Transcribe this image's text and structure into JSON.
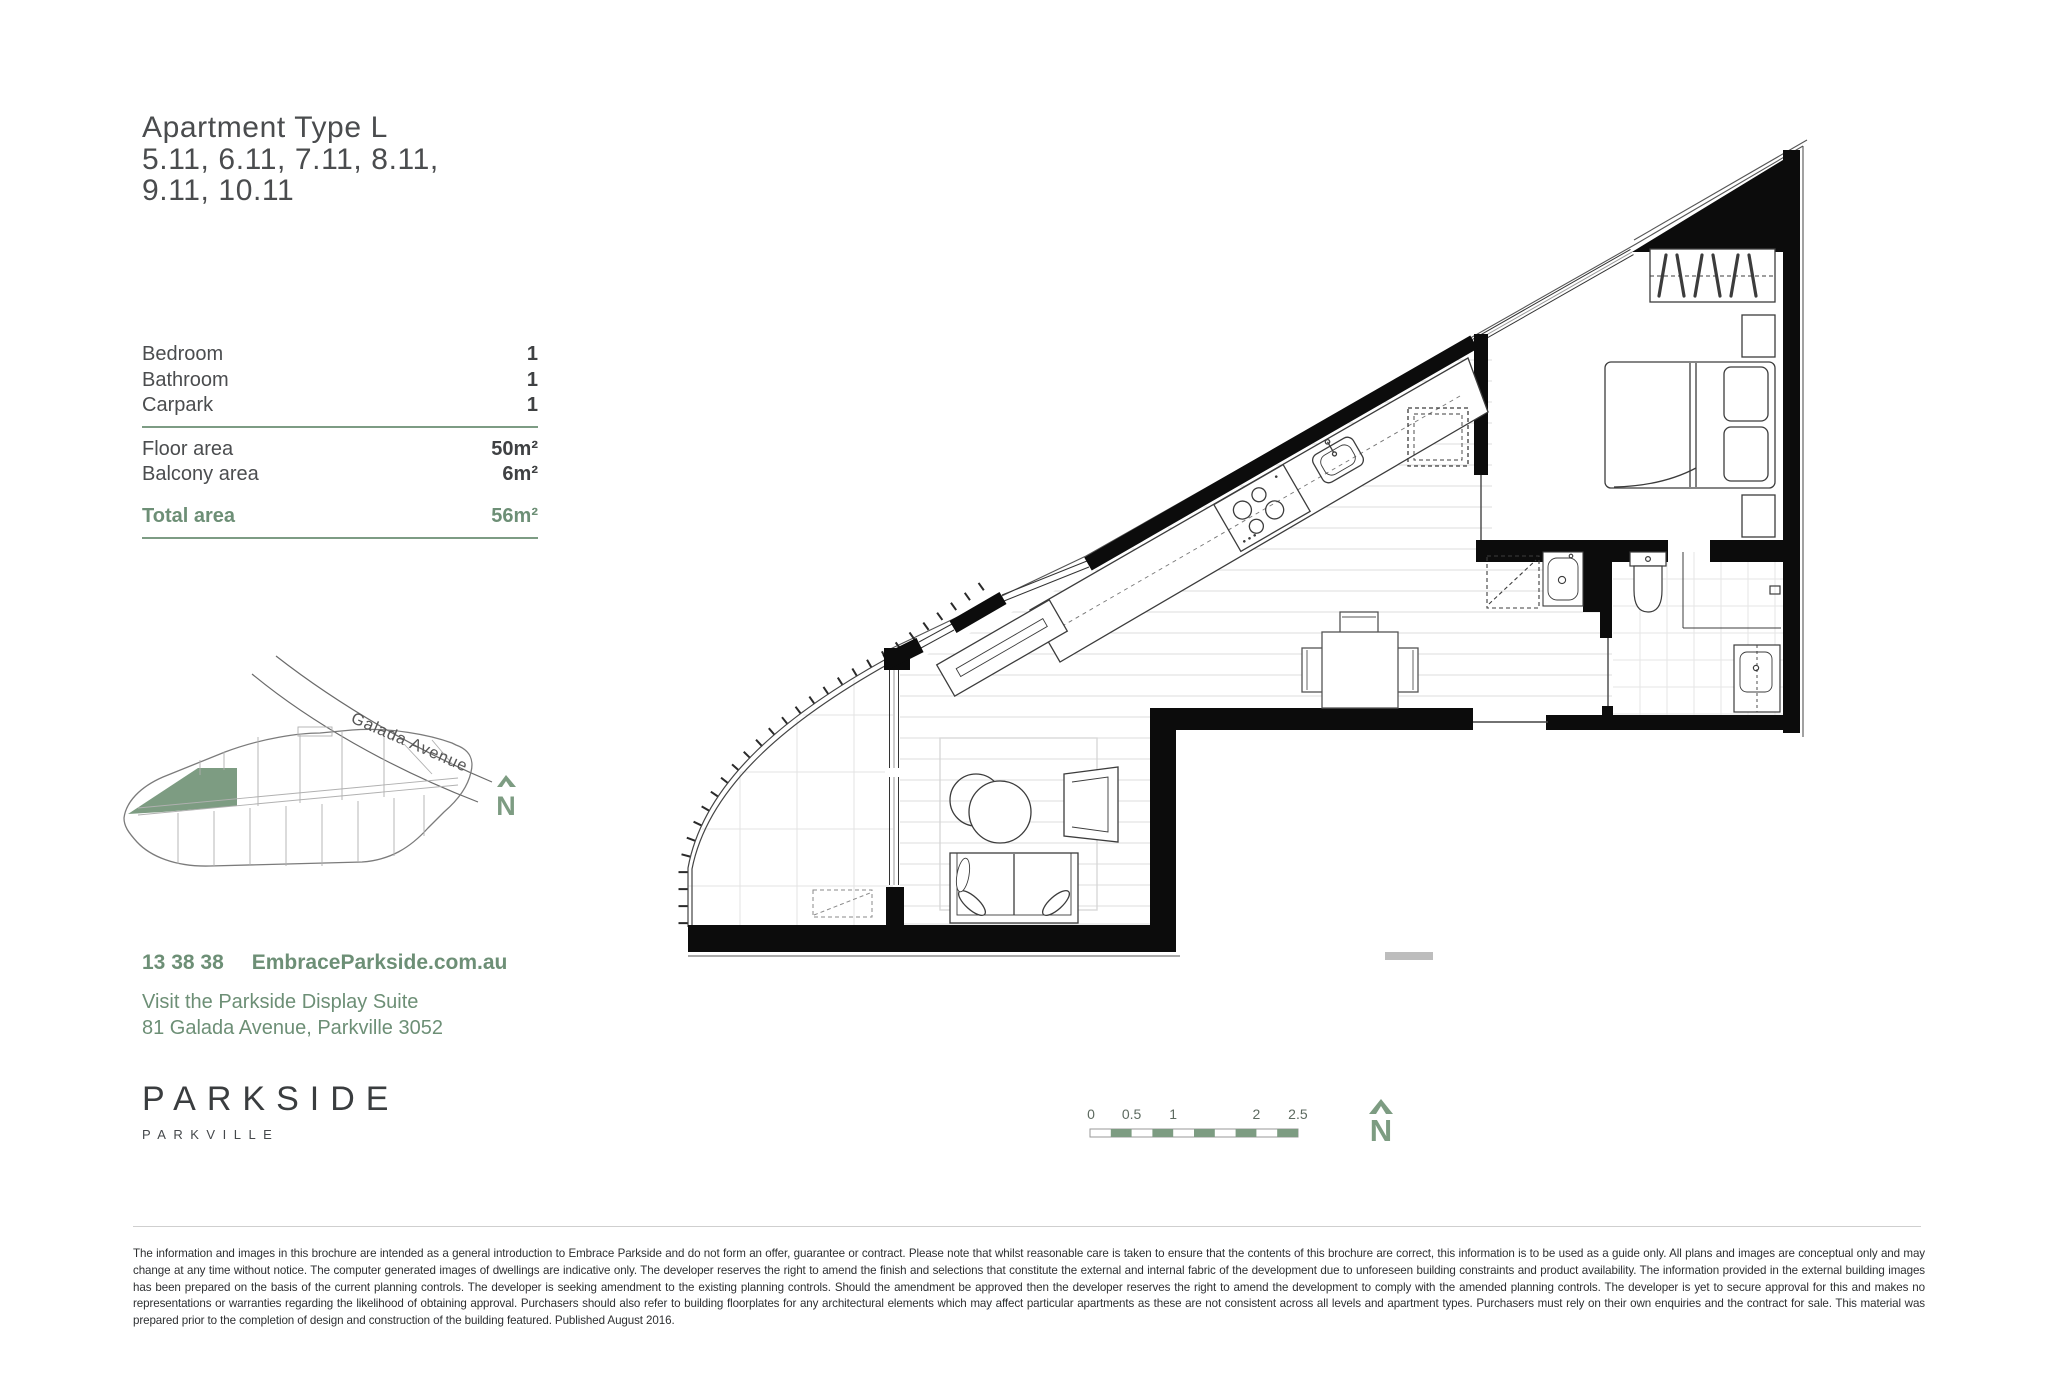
{
  "colors": {
    "accent_green_text": "#6d8f76",
    "accent_green_fill": "#7d9c82",
    "wall_black": "#0c0c0c",
    "text_dark": "#4a4c4e"
  },
  "header": {
    "title": "Apartment Type L",
    "units_line1": "5.11, 6.11, 7.11, 8.11,",
    "units_line2": "9.11, 10.11"
  },
  "spec_table": {
    "feature_rows": [
      {
        "label": "Bedroom",
        "value": "1"
      },
      {
        "label": "Bathroom",
        "value": "1"
      },
      {
        "label": "Carpark",
        "value": "1"
      }
    ],
    "area_rows": [
      {
        "label": "Floor area",
        "value": "50m²"
      },
      {
        "label": "Balcony area",
        "value": "6m²"
      }
    ],
    "total_row": {
      "label": "Total area",
      "value": "56m²"
    }
  },
  "site_map": {
    "street_label": "Galada Avenue",
    "north_label": "N"
  },
  "contact": {
    "phone": "13 38 38",
    "website": "EmbraceParkside.com.au",
    "visit_line1": "Visit the Parkside Display Suite",
    "visit_line2": "81 Galada Avenue, Parkville 3052"
  },
  "logo": {
    "brand": "PARKSIDE",
    "suburb": "PARKVILLE"
  },
  "floor_plan": {
    "scale_bar_labels": [
      "0",
      "0.5",
      "1",
      "2",
      "2.5"
    ],
    "north_label": "N"
  },
  "disclaimer": "The information and images in this brochure are intended as a general introduction to Embrace Parkside and do not form an offer, guarantee or contract. Please note that whilst reasonable care is taken to ensure that the contents of this brochure are correct, this information is to be used as a guide only. All plans and images are conceptual only and may change at any time without notice. The computer generated images of dwellings are indicative only. The developer reserves the right to amend the finish and selections that constitute the external and internal fabric of the development due to unforeseen building constraints and product availability. The information provided in the external building images has been prepared on the basis of the current planning controls. The developer is seeking amendment to the existing planning controls. Should the amendment be approved then the developer reserves the right to amend the development to comply with the amended planning controls. The developer is yet to secure approval for this and makes no representations or warranties regarding the likelihood of obtaining approval. Purchasers should also refer to building floorplates for any architectural elements which may affect particular apartments as these are not consistent across all levels and apartment types. Purchasers must rely on their own enquiries and the contract for sale. This material was prepared prior to the completion of design and construction of the building featured. Published August 2016."
}
